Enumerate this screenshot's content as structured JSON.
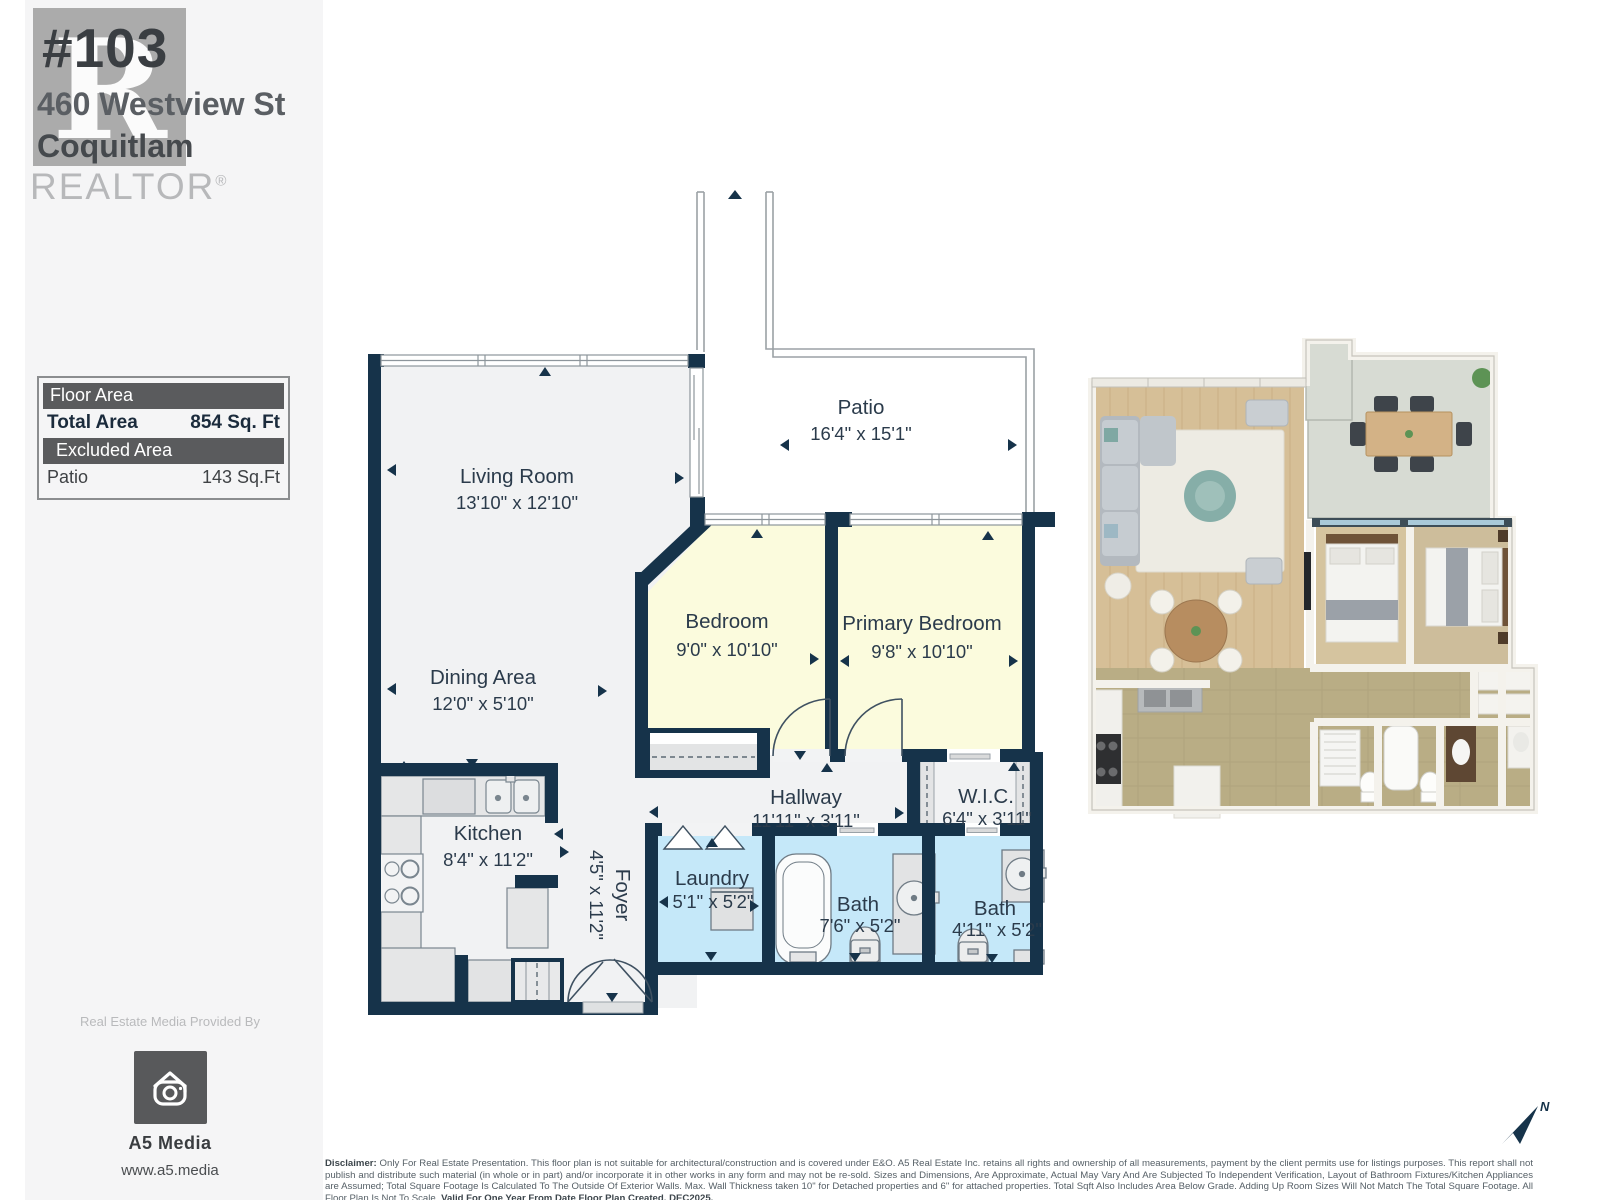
{
  "header": {
    "unit_number": "#103",
    "street": "460 Westview St",
    "city": "Coquitlam",
    "watermark_letter": "R",
    "watermark_wordmark": "REALTOR",
    "registered_symbol": "®"
  },
  "area_summary": {
    "floor_area_header": "Floor Area",
    "total_area_label": "Total Area",
    "total_area_value": "854 Sq. Ft",
    "excluded_area_header": "Excluded Area",
    "excluded_name": "Patio",
    "excluded_value": "143 Sq.Ft"
  },
  "floor_plan": {
    "rooms": [
      {
        "name": "Living Room",
        "dims": "13'10\" x 12'10\""
      },
      {
        "name": "Patio",
        "dims": "16'4\" x 15'1\""
      },
      {
        "name": "Bedroom",
        "dims": "9'0\" x 10'10\""
      },
      {
        "name": "Primary Bedroom",
        "dims": "9'8\" x 10'10\""
      },
      {
        "name": "Dining Area",
        "dims": "12'0\" x 5'10\""
      },
      {
        "name": "Kitchen",
        "dims": "8'4\" x 11'2\""
      },
      {
        "name": "Foyer",
        "dims": "4'5\" x 11'2\""
      },
      {
        "name": "Hallway",
        "dims": "11'11\" x 3'11\""
      },
      {
        "name": "W.I.C.",
        "dims": "6'4\" x 3'11\""
      },
      {
        "name": "Laundry",
        "dims": "5'1\" x 5'2\""
      },
      {
        "name": "Bath",
        "dims": "7'6\" x 5'2\""
      },
      {
        "name": "Bath",
        "dims": "4'11\" x 5'2\""
      }
    ]
  },
  "provider": {
    "caption": "Real Estate Media Provided By",
    "name": "A5 Media",
    "website": "www.a5.media"
  },
  "compass": {
    "north_label": "N"
  },
  "disclaimer": {
    "label": "Disclaimer:",
    "body": " Only For Real Estate Presentation. This floor plan is not suitable for architectural/construction and is covered under E&O. A5 Real Estate Inc. retains all rights and ownership of all measurements, payment by the client permits use for listings purposes. This report shall not publish and distribute such material (in whole or in part) and/or incorporate it in other works in any form and may not be re-sold. Sizes and Dimensions, Are Approximate, Actual May Vary And Are Subjected To Independent Verification, Layout of Bathroom Fixtures/Kitchen Appliances are Assumed; Total Square Footage Is Calculated To The Outside Of Exterior Walls. Max. Wall Thickness taken 10\" for Detached properties and 6\" for attached properties. Total Sqft Also Includes Area Below Grade. Adding Up Room Sizes Will Not Match The Total Square Footage. All Floor Plan Is Not To Scale. ",
    "bold_tail": "Valid For One Year From Date Floor Plan Created. DEC2025."
  },
  "colors": {
    "wall": "#16334a",
    "bedroom_fill": "#fbfbdd",
    "bath_fill": "#c5e8f9",
    "floor_fill": "#f1f2f3",
    "label_text": "#2b3b4b"
  }
}
